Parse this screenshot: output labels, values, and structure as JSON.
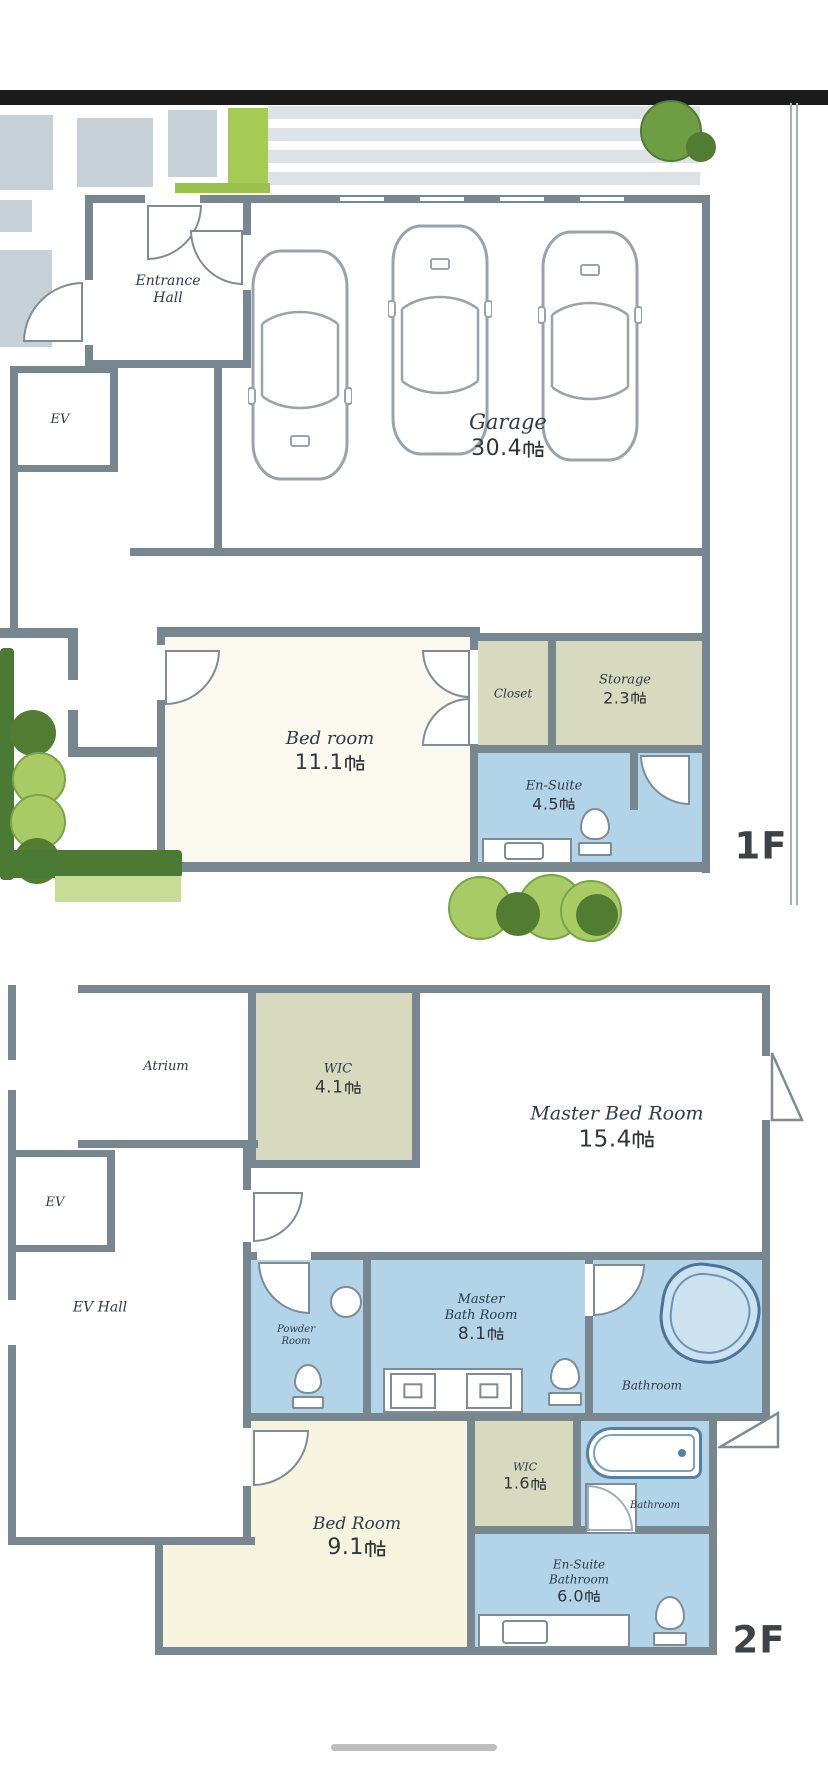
{
  "unit": "帖",
  "floor1": {
    "tag": "1F",
    "entrance_hall": "Entrance Hall",
    "elevator": "EV",
    "garage": {
      "name": "Garage",
      "size": "30.4"
    },
    "bedroom": {
      "name": "Bed room",
      "size": "11.1"
    },
    "closet": {
      "name": "Closet"
    },
    "storage": {
      "name": "Storage",
      "size": "2.3"
    },
    "ensuite": {
      "name": "En-Suite",
      "size": "4.5"
    }
  },
  "floor2": {
    "tag": "2F",
    "atrium": "Atrium",
    "wic": {
      "name": "WIC",
      "size": "4.1"
    },
    "master_bedroom": {
      "name": "Master Bed Room",
      "size": "15.4"
    },
    "elevator": "EV",
    "ev_hall": "EV Hall",
    "powder_room": {
      "line1": "Powder",
      "line2": "Room"
    },
    "master_bathroom": {
      "line1": "Master",
      "line2": "Bath Room",
      "size": "8.1"
    },
    "bathroom": "Bathroom",
    "wic_small": {
      "name": "WIC",
      "size": "1.6"
    },
    "bathroom_small": "Bathroom",
    "bedroom": {
      "name": "Bed Room",
      "size": "9.1"
    },
    "ensuite_bathroom": {
      "line1": "En-Suite",
      "line2": "Bathroom",
      "size": "6.0"
    }
  },
  "colors": {
    "wall": "#77868f",
    "bathroom_blue": "#b3d3e8",
    "storage_olive": "#d7dabe",
    "bedroom_cream": "#f6f3df",
    "greenery_light": "#a9cb66",
    "greenery_dark": "#527c31",
    "label_text": "#2e3b49"
  }
}
